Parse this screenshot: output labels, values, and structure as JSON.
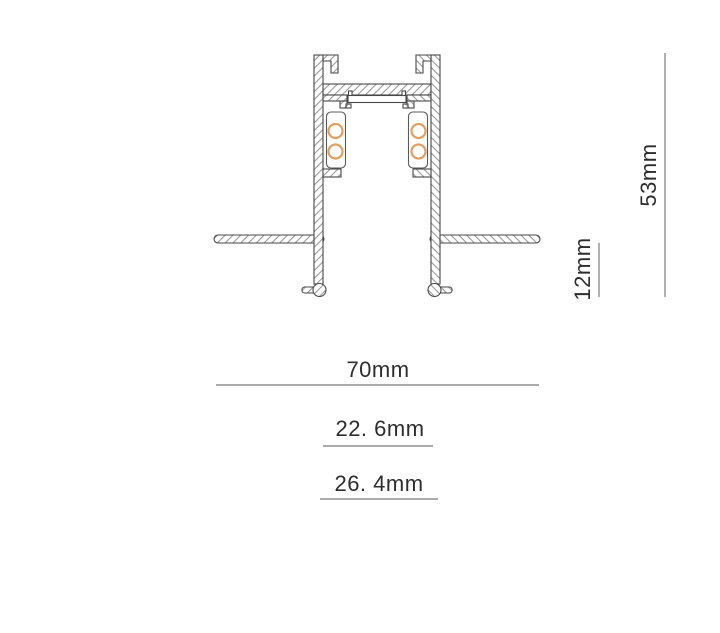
{
  "drawing": {
    "kind": "profile-cross-section",
    "dimensions": {
      "overall_height": {
        "label": "53mm",
        "value": 53,
        "unit": "mm"
      },
      "recess_depth": {
        "label": "12mm",
        "value": 12,
        "unit": "mm"
      },
      "flange_width": {
        "label": "70mm",
        "value": 70,
        "unit": "mm"
      },
      "inner_width": {
        "label": "22. 6mm",
        "value": 22.6,
        "unit": "mm"
      },
      "outer_width": {
        "label": "26. 4mm",
        "value": 26.4,
        "unit": "mm"
      }
    },
    "conductor_rings_per_side": 2,
    "colors": {
      "background": "#ffffff",
      "outline": "#474747",
      "hatch": "#9a9a9a",
      "conductor": "#e2a060",
      "dimension_line": "#8f8f8f",
      "dimension_text": "#2d2d2d"
    }
  }
}
